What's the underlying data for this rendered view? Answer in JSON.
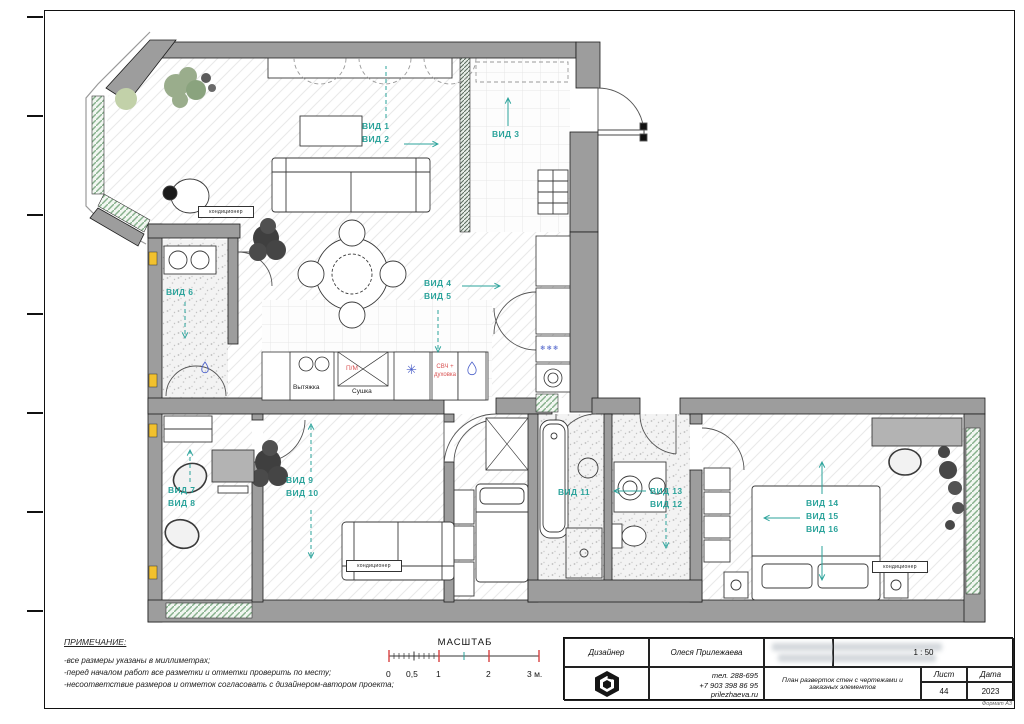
{
  "views": {
    "v1": "ВИД 1",
    "v2": "ВИД 2",
    "v3": "ВИД 3",
    "v4": "ВИД 4",
    "v5": "ВИД 5",
    "v6": "ВИД 6",
    "v7": "ВИД 7",
    "v8": "ВИД 8",
    "v9": "ВИД 9",
    "v10": "ВИД 10",
    "v11": "ВИД 11",
    "v12": "ВИД 12",
    "v13": "ВИД 13",
    "v14": "ВИД 14",
    "v15": "ВИД 15",
    "v16": "ВИД 16"
  },
  "kitchen": {
    "hood_label": "Вытяжка",
    "dry_label": "Сушка",
    "dishwasher_label": "П/М",
    "oven_label": "СВЧ +\nдуховка"
  },
  "symbols": {
    "ac_label": "кондиционер",
    "freezer_marks": "❄❄❄",
    "fridge_mark": "✳"
  },
  "notes": {
    "title": "ПРИМЕЧАНИЕ:",
    "items": [
      "-все размеры указаны в миллиметрах;",
      "-перед началом работ все разметки и отметки проверить по месту;",
      "-несоответствие размеров и отметок согласовать с дизайнером-автором проекта;"
    ]
  },
  "scalebar": {
    "title": "МАСШТАБ",
    "ticks": [
      "0",
      "0,5",
      "1",
      "2",
      "3 м."
    ]
  },
  "titleblock": {
    "designer_label": "Дизайнер",
    "designer_name": "Олеся Прилежаева",
    "phone1": "тел. 288-695",
    "phone2": "+7 903 398 86 95",
    "site": "prilezhaeva.ru",
    "drawing_title": "План разверток стен с чертежами и заказных элементов",
    "scale_value": "1 : 50",
    "sheet_label": "Лист",
    "date_label": "Дата",
    "sheet_number": "44",
    "date_value": "2023",
    "format_label": "Формат А3"
  },
  "colors": {
    "view_accent": "#2ba39b",
    "warn_red": "#d95252",
    "wall_gray": "#9d9d9d",
    "marker_yellow": "#f2c12e",
    "cold_blue": "#4a5fc9"
  }
}
